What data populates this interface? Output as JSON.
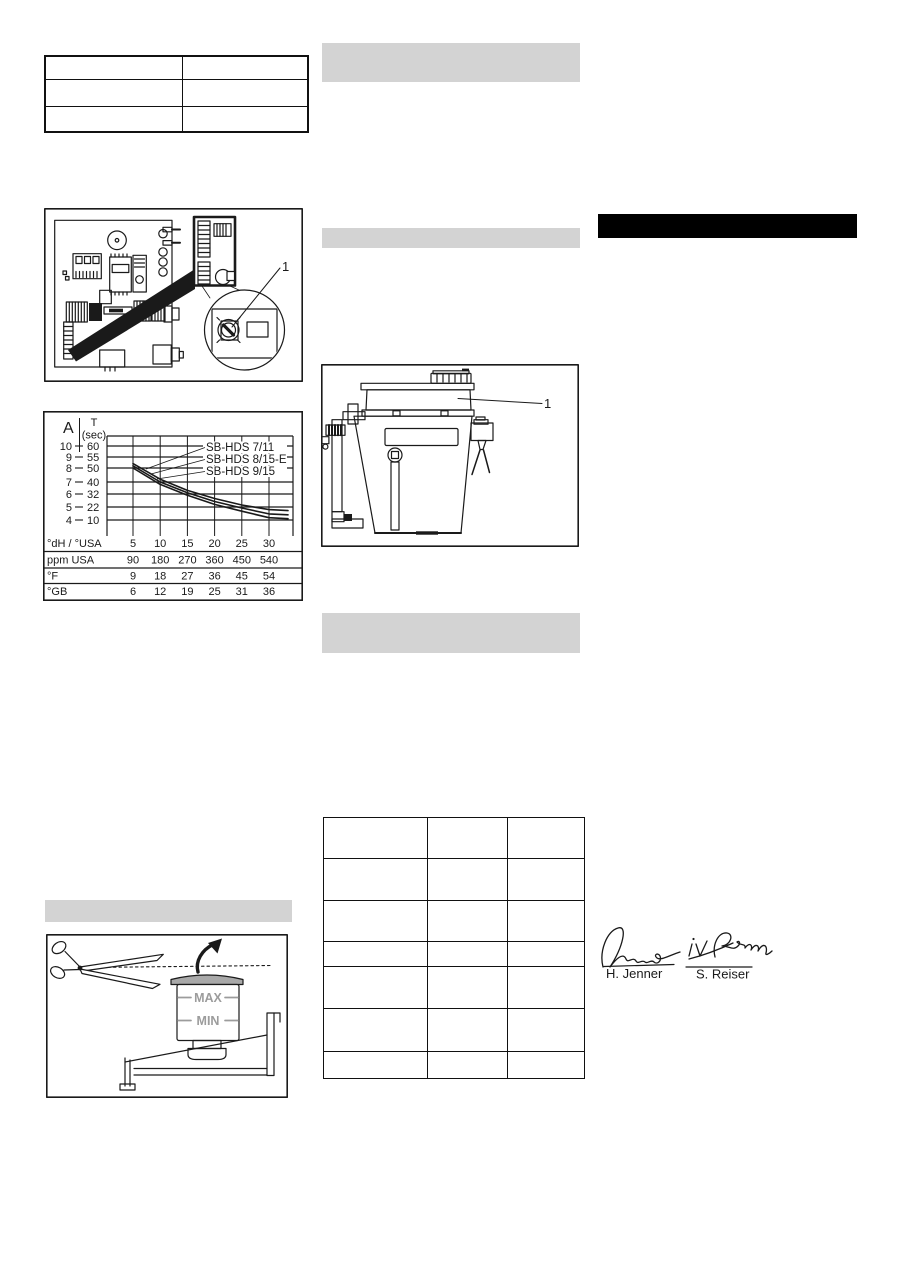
{
  "colors": {
    "paper": "#ffffff",
    "ink": "#1a1a1a",
    "section_bar_gray": "#d3d3d3",
    "black_bar": "#000000",
    "reservoir_cap_gray": "#a9a9a9",
    "reservoir_label_gray": "#9c9c9c"
  },
  "top_left_table": {
    "rows": 3,
    "columns": 2
  },
  "middle_table": {
    "rows": 7,
    "columns": 3
  },
  "pcb_figure": {
    "callout_label": "1"
  },
  "container_figure": {
    "callout_label": "1"
  },
  "reservoir_figure": {
    "max_label": "MAX",
    "min_label": "MIN"
  },
  "signatures": {
    "left_printed_name": "H. Jenner",
    "right_printed_name": "S. Reiser",
    "right_handwritten": "i.V. Reiser"
  },
  "chart_data": {
    "type": "line",
    "axis_header_left": "A",
    "axis_header_right_line1": "T",
    "axis_header_right_line2": "(sec)",
    "grid": true,
    "legend_position": "top-right-inside",
    "A_range": [
      4,
      10
    ],
    "T_range": [
      10,
      60
    ],
    "x_range": [
      5,
      30
    ],
    "y_ticks": [
      {
        "A": 10,
        "T": 60
      },
      {
        "A": 9,
        "T": 55
      },
      {
        "A": 8,
        "T": 50
      },
      {
        "A": 7,
        "T": 40
      },
      {
        "A": 6,
        "T": 32
      },
      {
        "A": 5,
        "T": 22
      },
      {
        "A": 4,
        "T": 10
      }
    ],
    "x_axis_rows": [
      {
        "label": "°dH / °USA",
        "values": [
          5,
          10,
          15,
          20,
          25,
          30
        ]
      },
      {
        "label": "ppm USA",
        "values": [
          90,
          180,
          270,
          360,
          450,
          540
        ]
      },
      {
        "label": "°F",
        "values": [
          9,
          18,
          27,
          36,
          45,
          54
        ]
      },
      {
        "label": "°GB",
        "values": [
          6,
          12,
          19,
          25,
          31,
          36
        ]
      }
    ],
    "series": [
      {
        "name": "SB-HDS 7/11",
        "x": [
          5,
          10,
          15,
          20,
          25,
          30,
          33.5
        ],
        "A": [
          8.4,
          7.2,
          6.3,
          5.65,
          5.15,
          4.8,
          4.72
        ]
      },
      {
        "name": "SB-HDS 8/15-E",
        "x": [
          5,
          10,
          15,
          20,
          25,
          30,
          33.5
        ],
        "A": [
          8.2,
          7.0,
          6.1,
          5.42,
          4.92,
          4.47,
          4.4
        ]
      },
      {
        "name": "SB-HDS 9/15",
        "x": [
          5,
          10,
          15,
          20,
          25,
          30,
          33.5
        ],
        "A": [
          8.0,
          6.8,
          5.9,
          5.2,
          4.68,
          4.18,
          4.1
        ]
      }
    ]
  }
}
